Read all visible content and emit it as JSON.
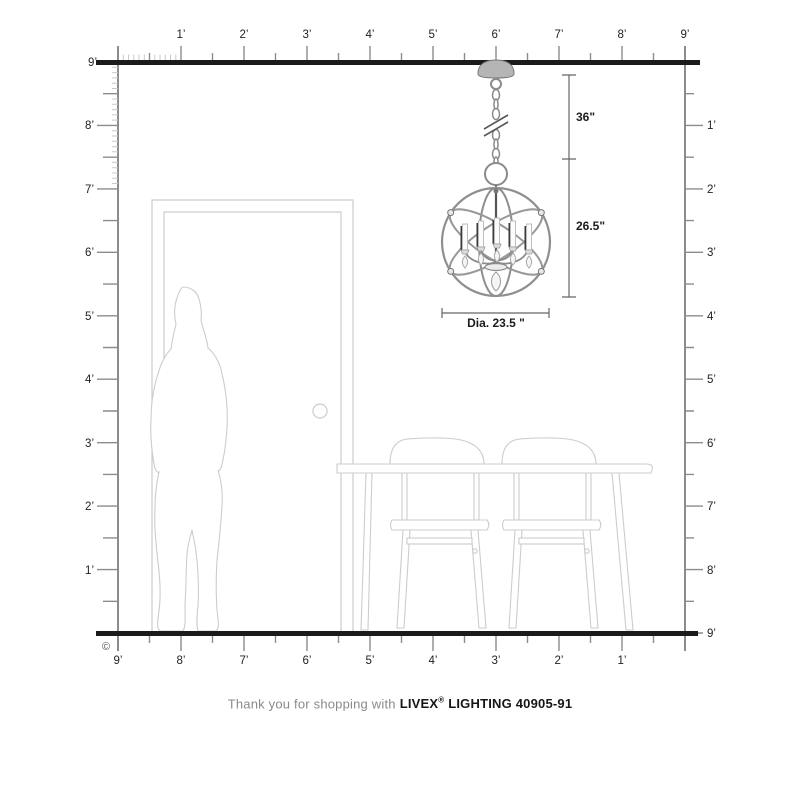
{
  "rulers": {
    "top": {
      "labels": [
        "1’",
        "2’",
        "3’",
        "4’",
        "5’",
        "6’",
        "7’",
        "8’",
        "9’"
      ]
    },
    "left": {
      "labels": [
        "9’",
        "8’",
        "7’",
        "6’",
        "5’",
        "4’",
        "3’",
        "2’",
        "1’"
      ]
    },
    "right": {
      "labels": [
        "1’",
        "2’",
        "3’",
        "4’",
        "5’",
        "6’",
        "7’",
        "8’",
        "9’"
      ]
    },
    "bottom": {
      "labels": [
        "9’",
        "8’",
        "7’",
        "6’",
        "5’",
        "4’",
        "3’",
        "2’",
        "1’"
      ]
    }
  },
  "dimensions": {
    "chain_drop": "36\"",
    "fixture_height": "26.5\"",
    "fixture_diameter": "Dia. 23.5 \""
  },
  "caption": {
    "prefix": "Thank you for shopping with",
    "brand": "LIVEX",
    "registered_mark": "®",
    "suffix": "LIGHTING 40905-91"
  },
  "copyright_symbol": "©",
  "colors": {
    "structure_line": "#1b1b1b",
    "ruler_line": "#8c8c8c",
    "inch_tick": "#c9c9c9",
    "furniture_outline": "#cccccc",
    "fixture_metal": "#8f8f8f",
    "label_text": "#222222",
    "caption_muted": "#8a8a8a"
  }
}
